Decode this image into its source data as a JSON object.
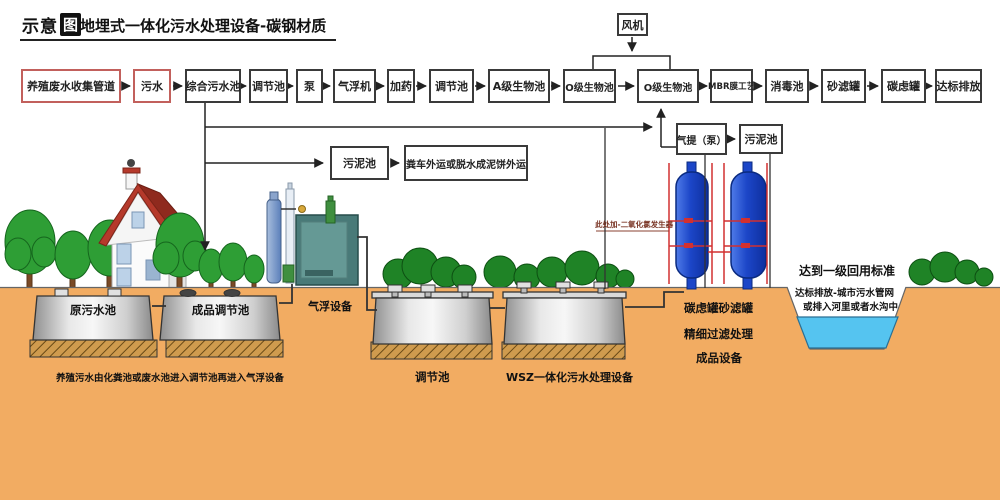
{
  "header": {
    "logo_text": "示意",
    "logo_badge": "图",
    "title": "地埋式一体化污水处理设备-碳钢材质"
  },
  "flow": {
    "top_row": [
      {
        "label": "养殖废水收集管道"
      },
      {
        "label": "污水"
      },
      {
        "label": "综合污水池"
      },
      {
        "label": "调节池"
      },
      {
        "label": "泵"
      },
      {
        "label": "气浮机"
      },
      {
        "label": "加药"
      },
      {
        "label": "调节池"
      },
      {
        "label": "A级生物池"
      },
      {
        "label": "O级生物池"
      },
      {
        "label": "O级生物池"
      },
      {
        "label": "MBR膜工艺"
      },
      {
        "label": "消毒池"
      },
      {
        "label": "砂滤罐"
      },
      {
        "label": "碳虑罐"
      },
      {
        "label": "达标排放"
      }
    ],
    "fan": "风机",
    "airlift_pump": "气提（泵）",
    "sludge_pool_right": "污泥池",
    "sludge_pool_left": "污泥池",
    "sludge_truck": "粪车外运或脱水成泥饼外运"
  },
  "scene": {
    "raw_pool": "原污水池",
    "product_pool": "成品调节池",
    "flotation": "气浮设备",
    "mid_pool": "调节池",
    "wsz": "WSZ一体化污水处理设备",
    "filter_line1": "碳虑罐砂滤罐",
    "filter_line2": "精细过滤处理",
    "filter_line3": "成品设备",
    "standard_line1": "达到一级回用标准",
    "standard_line2": "达标排放-城市污水管网",
    "standard_line3": "或排入河里或者水沟中",
    "chlorine_note": "此处加-二氧化氯发生器",
    "caption": "养殖污水由化粪池或废水池进入调节池再进入气浮设备"
  },
  "colors": {
    "ground": "#F2AC62",
    "water": "#55C4F0",
    "filter_tank_blue": "#1C46C8",
    "pipe_red": "#D23030",
    "red_box_border": "#C2605C",
    "roof_red": "#B5392B",
    "tree_green": "#2E9E35",
    "bush_green": "#1F8326"
  }
}
